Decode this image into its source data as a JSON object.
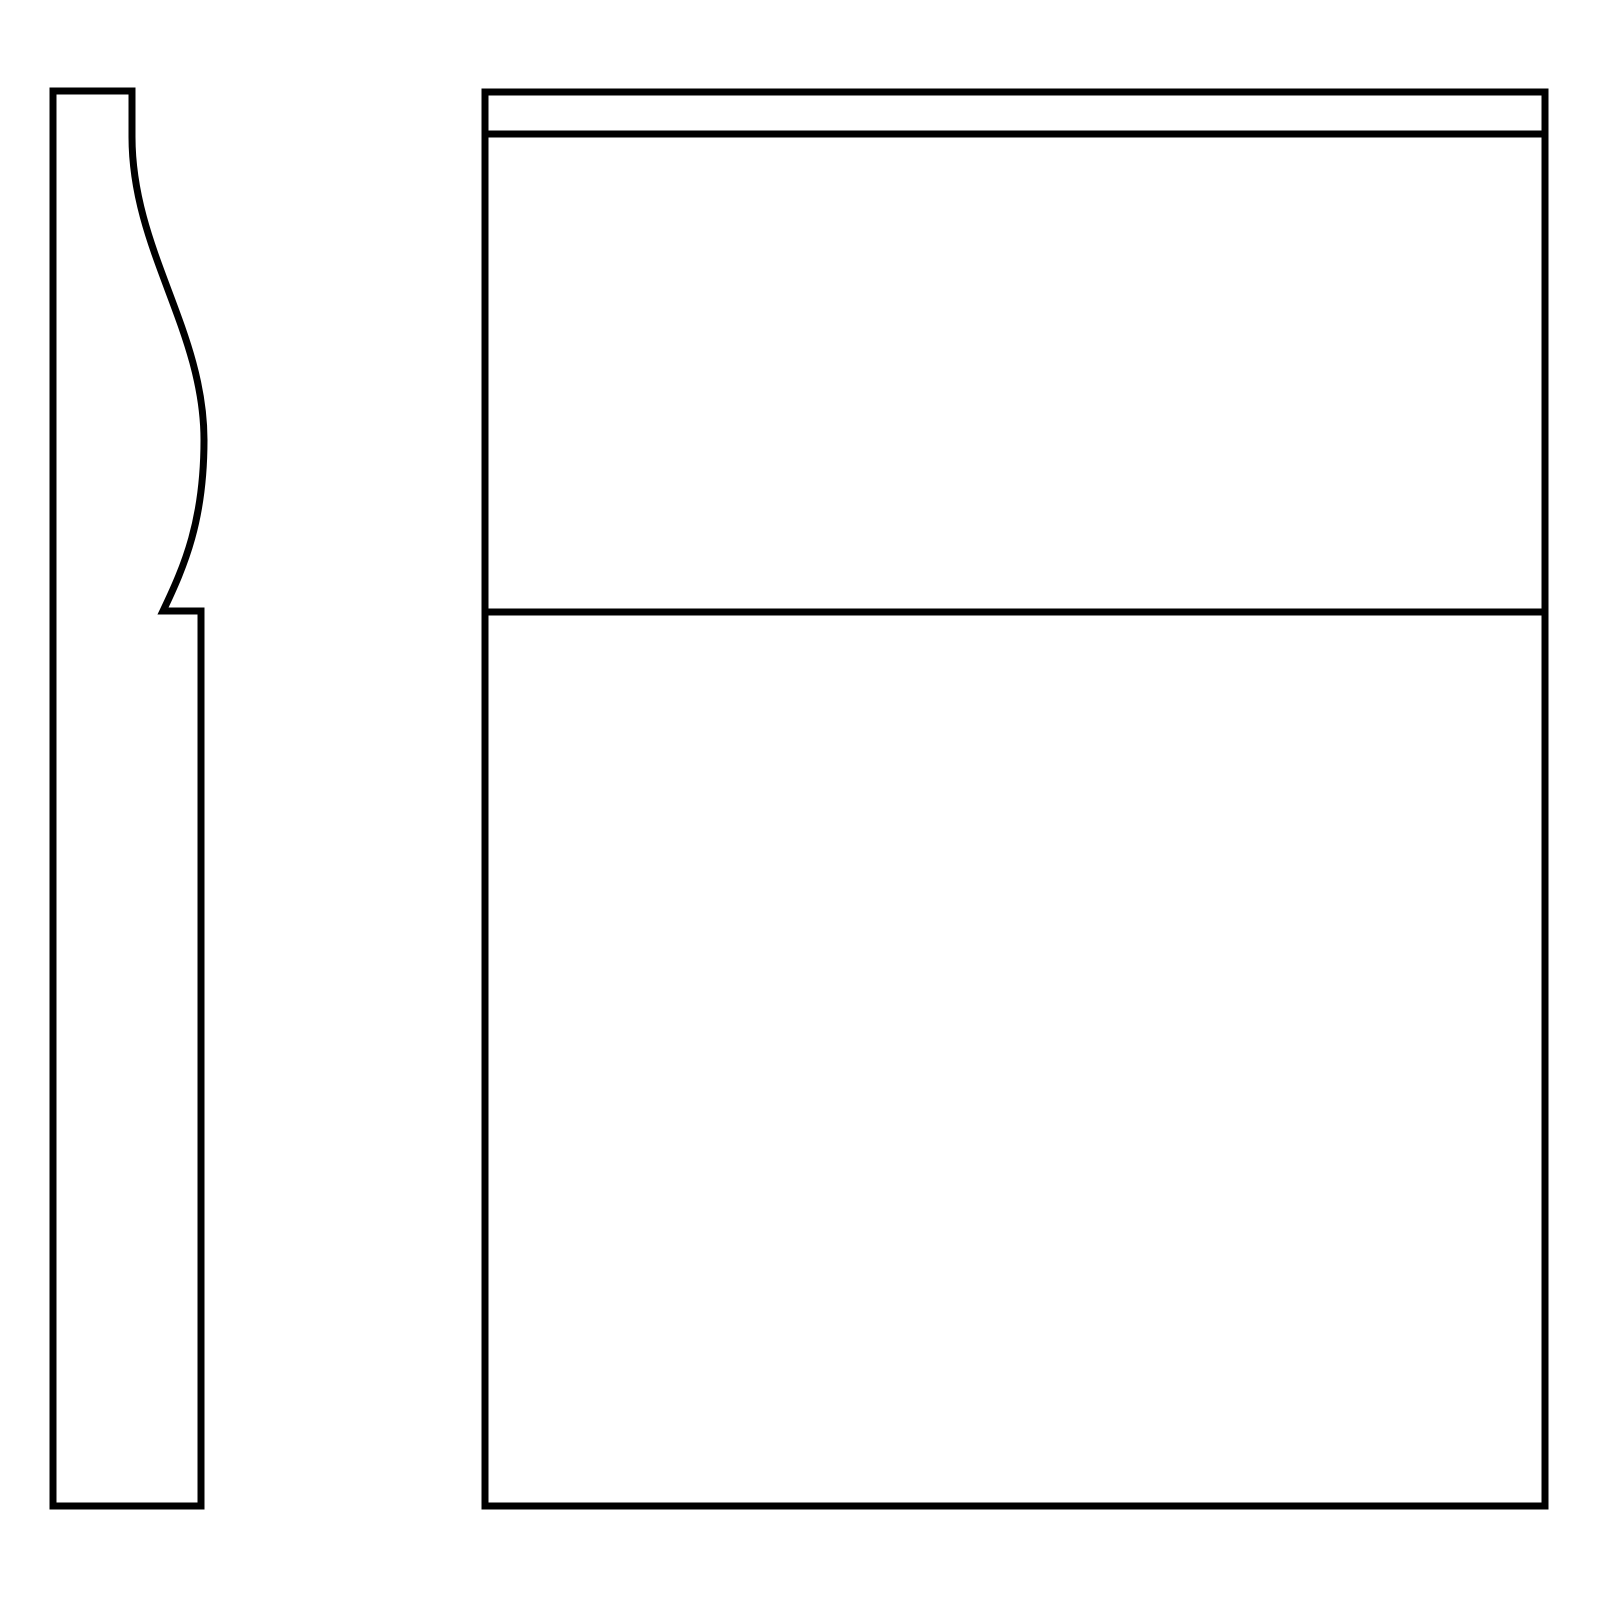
{
  "canvas": {
    "width": 1600,
    "height": 1600,
    "background_color": "#ffffff"
  },
  "drawing": {
    "description": "two-view technical drawing: side profile with ogee curve and front elevation panel",
    "stroke_color": "#000000",
    "stroke_width": 7,
    "fill_color": "none",
    "shapes": [
      {
        "name": "side-profile-outline",
        "type": "path",
        "d": "M 53 91 L 132 91 L 132 137 C 132 250 204 330 204 440 C 204 520 185 565 163 611 L 201 611 L 201 1506 L 53 1506 Z"
      },
      {
        "name": "front-panel-outline",
        "type": "path",
        "d": "M 485 92 L 1545 92 L 1545 1506 L 485 1506 Z"
      },
      {
        "name": "front-panel-top-rail-line",
        "type": "line",
        "x1": 485,
        "y1": 134,
        "x2": 1545,
        "y2": 134
      },
      {
        "name": "front-panel-mid-rail-line",
        "type": "line",
        "x1": 485,
        "y1": 612,
        "x2": 1545,
        "y2": 612
      }
    ]
  }
}
